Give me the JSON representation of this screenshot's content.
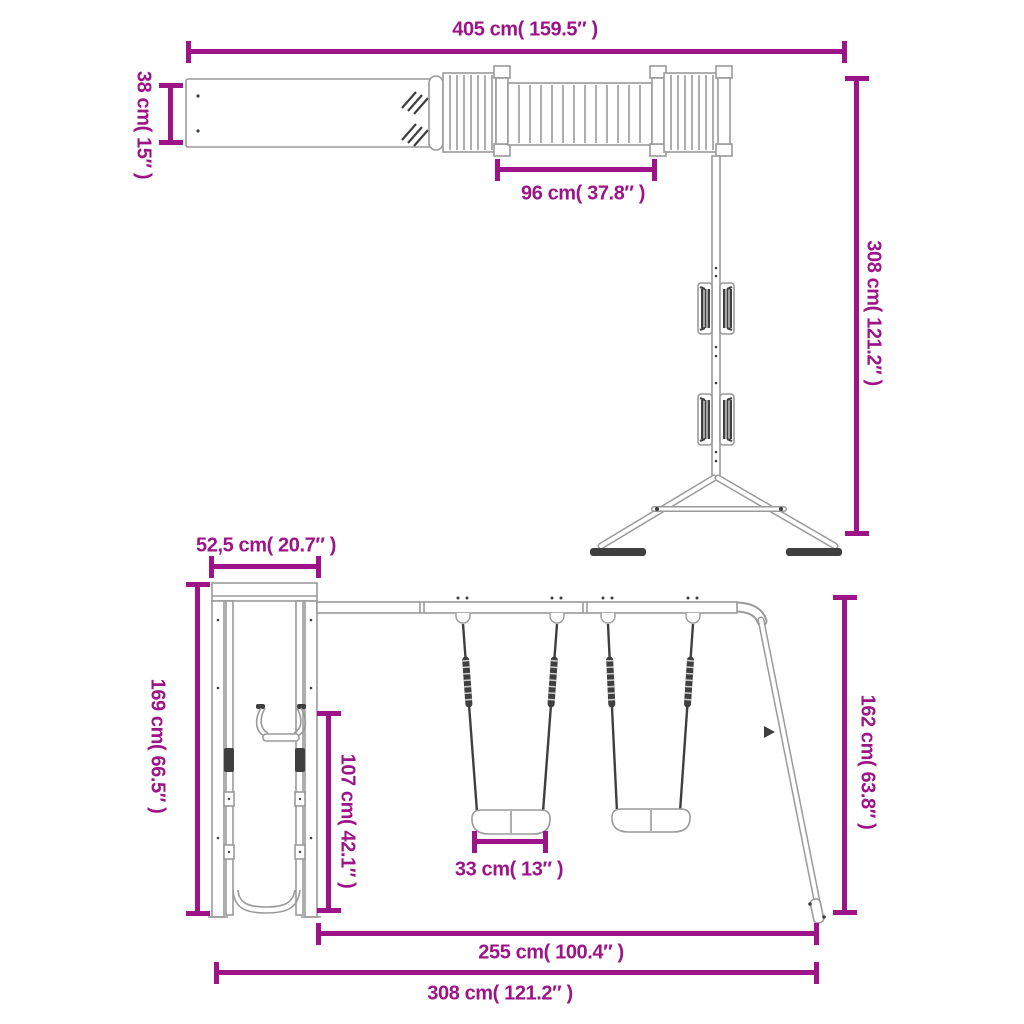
{
  "colors": {
    "accent": "#9C1487",
    "outline": "#9A9A9A",
    "dark": "#3F3F3F",
    "background": "#FFFFFF"
  },
  "dims": {
    "t405": "405 cm( 159.5″ )",
    "t38": "38 cm( 15″ )",
    "t96": "96 cm( 37.8″ )",
    "t308": "308 cm( 121.2″ )",
    "b52": "52,5 cm( 20.7″ )",
    "b169": "169 cm( 66.5″ )",
    "b107": "107 cm( 42.1″ )",
    "b33": "33 cm( 13″ )",
    "b162": "162 cm( 63.8″ )",
    "b255": "255 cm( 100.4″ )",
    "b308": "308 cm( 121.2″ )"
  }
}
